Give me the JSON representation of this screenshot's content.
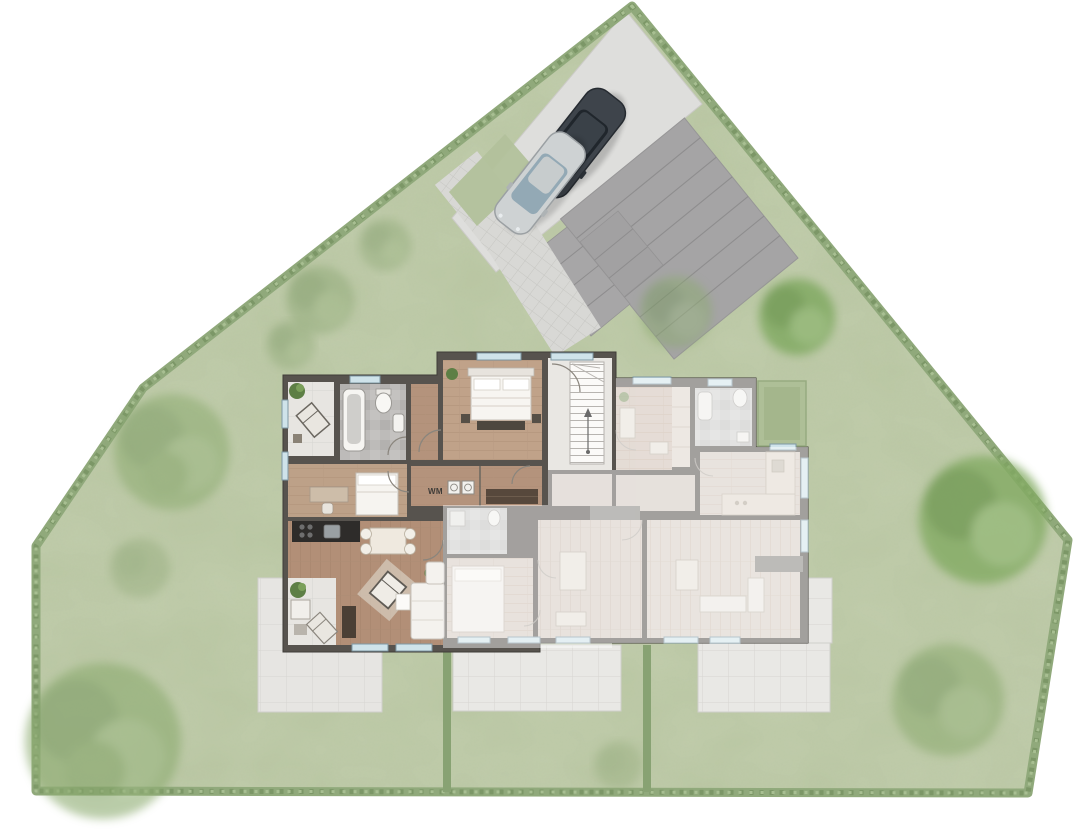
{
  "floor_plan": {
    "labels": {
      "washing_machine": "WM"
    },
    "apartments": {
      "left": {
        "style": "highlighted"
      },
      "right": {
        "style": "faded"
      }
    }
  },
  "site": {
    "cars": {
      "count": 2,
      "colors": [
        "#3e444b",
        "#ced2d3"
      ]
    },
    "features": [
      "lawn",
      "hedge border",
      "parking area",
      "carport slab",
      "paved footpath",
      "terraces",
      "garden divider hedges",
      "trees"
    ]
  },
  "colors": {
    "background": "#ffffff",
    "lawn": "#b9c6a2",
    "hedge": "#90a97b",
    "hedge_dark": "#7c9767",
    "parking_pad": "#dededc",
    "carport": "#a5a4a5",
    "footpath": "#d8d8d5",
    "terrace": "#e9e8e5",
    "wall": "#57534e",
    "wood_floor": "#b4937c",
    "bath_tile": "#bbb9b7",
    "window_sill": "#cfe3ea",
    "car_dark": "#3e444b",
    "car_silver": "#ced2d3"
  }
}
